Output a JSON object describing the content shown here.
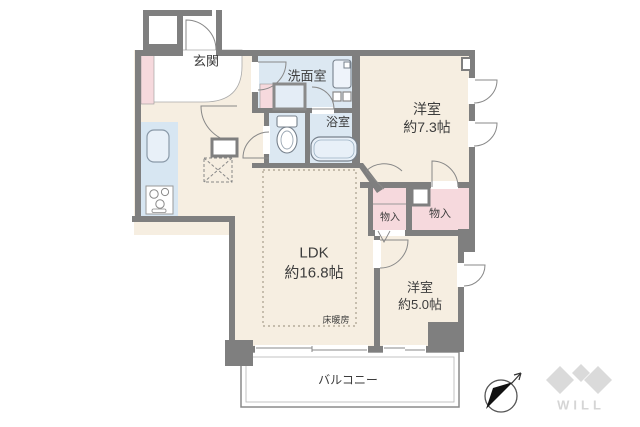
{
  "floor_plan": {
    "entrance": {
      "label": "玄関"
    },
    "washroom": {
      "label": "洗面室"
    },
    "bathroom": {
      "label": "浴室"
    },
    "western_room_1": {
      "name": "洋室",
      "size": "約7.3帖"
    },
    "western_room_2": {
      "name": "洋室",
      "size": "約5.0帖"
    },
    "ldk": {
      "name": "LDK",
      "size": "約16.8帖"
    },
    "floor_heating": {
      "label": "床暖房"
    },
    "closet_small": {
      "label": "物入"
    },
    "closet_large": {
      "label": "物入"
    },
    "balcony": {
      "label": "バルコニー"
    },
    "brand": {
      "name": "WILL"
    },
    "colors": {
      "wall": "#7f7f7f",
      "floor": "#f6eee1",
      "wet_area": "#dce8f2",
      "closet": "#f6d9dd",
      "kitchen_counter": "#d7e6f2",
      "brand_gray": "#d9d9d9"
    }
  }
}
